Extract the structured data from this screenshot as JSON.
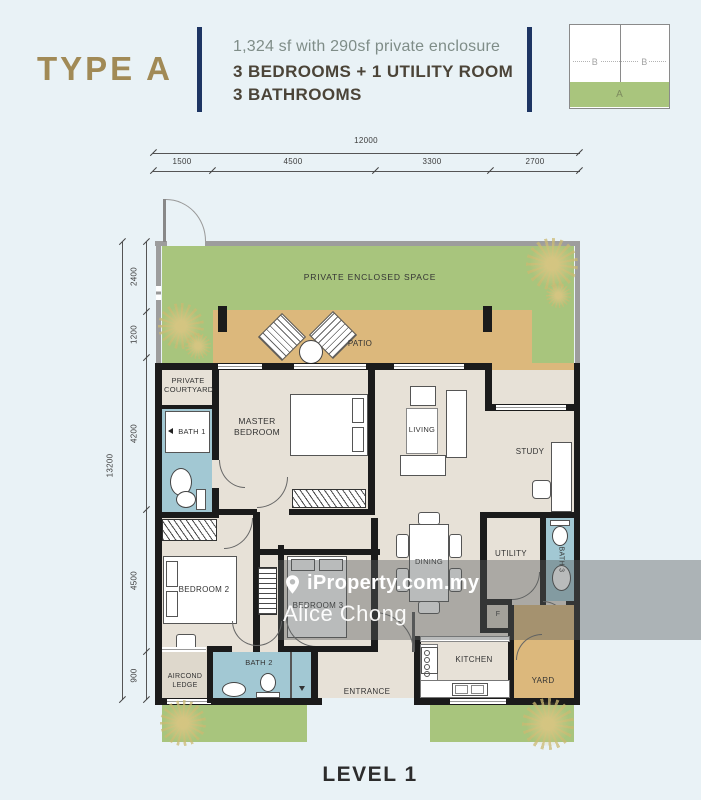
{
  "header": {
    "type_label": "TYPE A",
    "area_line": "1,324 sf with 290sf private enclosure",
    "config_line1": "3 BEDROOMS + 1 UTILITY ROOM",
    "config_line2": "3 BATHROOMS",
    "keyplan": {
      "b1": "B",
      "b2": "B",
      "a": "A"
    }
  },
  "dims": {
    "top": {
      "total": "12000",
      "segments": [
        "1500",
        "4500",
        "3300",
        "2700"
      ]
    },
    "left": {
      "total": "13200",
      "segments": [
        "2400",
        "1200",
        "4200",
        "4500",
        "900"
      ]
    }
  },
  "rooms": {
    "pes": "PRIVATE ENCLOSED SPACE",
    "patio": "PATIO",
    "private_courtyard": "PRIVATE COURTYARD",
    "bath1": "BATH 1",
    "master_bedroom": "MASTER BEDROOM",
    "living": "LIVING",
    "study": "STUDY",
    "dining": "DINING",
    "utility": "UTILITY",
    "bath3": "BATH 3",
    "bedroom2": "BEDROOM 2",
    "bedroom3": "BEDROOM 3",
    "bath2": "BATH 2",
    "aircond_ledge": "AIRCOND LEDGE",
    "entrance": "ENTRANCE",
    "kitchen": "KITCHEN",
    "yard": "YARD",
    "f": "F"
  },
  "watermark": {
    "brand": "iProperty.com.my",
    "agent": "Alice Chong"
  },
  "footer": {
    "level_label": "LEVEL 1"
  },
  "colors": {
    "accent_gold": "#a18a56",
    "navy": "#1d3563",
    "grass_green": "#a8c57d",
    "patio_tan": "#dcb87c",
    "bath_teal": "#a2c8d3",
    "wall_black": "#1b1b1b",
    "floor_beige": "#e7e1d7",
    "page_bg": "#e9f2f6"
  }
}
